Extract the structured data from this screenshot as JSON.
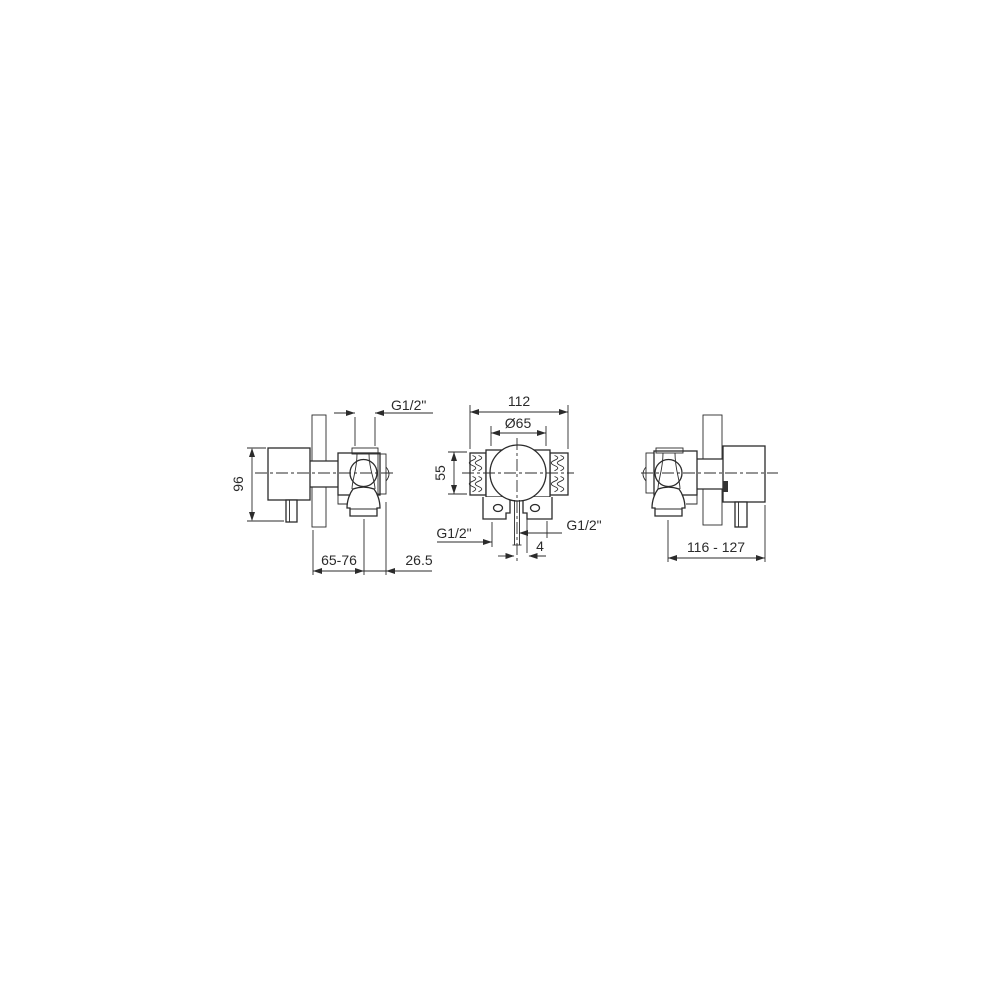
{
  "page": {
    "background": "#ffffff",
    "line_color": "#2b2b2b",
    "text_color": "#2b2b2b"
  },
  "drawing": {
    "type": "technical dimensional drawing, concealed shower mixer valve, three orthographic views"
  },
  "views": {
    "side_view_left": {
      "name": "side view facing right",
      "dims": {
        "top_thread": "G1/2\"",
        "height": "96",
        "wall_to_outlet": "65-76",
        "outlet_to_front": "26.5"
      }
    },
    "front_view": {
      "name": "front view",
      "dims": {
        "overall_width": "112",
        "handle_diameter": "Ø65",
        "body_height": "55",
        "left_port": "G1/2\"",
        "right_port": "G1/2\"",
        "outlet_offset": "4"
      }
    },
    "side_view_right": {
      "name": "side view facing left",
      "dims": {
        "wall_to_body": "116 - 127"
      }
    }
  }
}
